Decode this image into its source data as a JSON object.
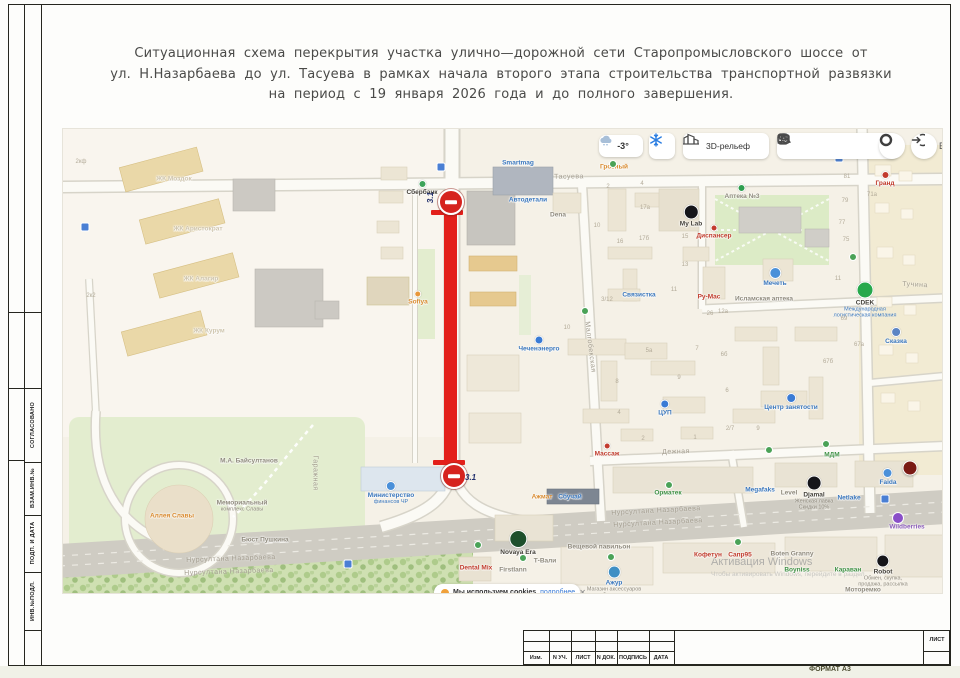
{
  "sheet": {
    "title_lines": [
      "Ситуационная схема перекрытия участка улично—дорожной сети Старопромысловского шоссе от",
      "ул. Н.Назарбаева до ул. Тасуева в рамках начала второго этапа строительства транспортной развязки",
      "на период с 19 января 2026 года и до полного завершения."
    ],
    "side_stamps": [
      "СОГЛАСОВАНО",
      "ВЗАМ.ИНВ.№",
      "ПОДП. И ДАТА",
      "ИНВ.№ПОДЛ."
    ],
    "title_block": {
      "columns": [
        "Изм.",
        "N УЧ.",
        "ЛИСТ",
        "N ДОК.",
        "ПОДПИСЬ",
        "ДАТА"
      ],
      "sheet_label": "ЛИСТ",
      "format_label": "ФОРМАТ А3"
    }
  },
  "map": {
    "controls": {
      "temperature": "-3°",
      "relief_label": "3D-рельеф",
      "login_hint": "В",
      "icon_names": [
        "weather-cloud-icon",
        "snowflake-icon",
        "3d-buildings-icon",
        "attractions-icon",
        "friends-icon",
        "briefcase-icon",
        "parking-icon",
        "layers-icon",
        "compass-icon",
        "login-arrow-icon"
      ]
    },
    "closure": {
      "sign_code": "3.1",
      "color": "#e3201b"
    },
    "cookie_banner": {
      "text": "Мы используем cookies",
      "link_label": "подробнее",
      "close_label": "✕"
    },
    "watermark": {
      "line1": "Активация Windows",
      "line2": "Чтобы активировать Windows, перейдите в раздел"
    },
    "streets": [
      {
        "label": "Тасуева",
        "x": 568,
        "y": 176,
        "r": -1
      },
      {
        "label": "Нурсултана Назарбаева",
        "x": 230,
        "y": 558,
        "r": -2
      },
      {
        "label": "Нурсултана Назарбаева",
        "x": 228,
        "y": 571,
        "r": -2
      },
      {
        "label": "Нурсултана Назарбаева",
        "x": 655,
        "y": 510,
        "r": -3
      },
      {
        "label": "Нурсултана Назарбаева",
        "x": 657,
        "y": 522,
        "r": -3
      },
      {
        "label": "Дежная",
        "x": 675,
        "y": 451,
        "r": -2
      },
      {
        "label": "Малгобекская",
        "x": 589,
        "y": 346,
        "r": 83
      },
      {
        "label": "Тучина",
        "x": 914,
        "y": 284,
        "r": 3
      },
      {
        "label": "Гаражная",
        "x": 314,
        "y": 472,
        "r": 90
      }
    ],
    "pois": [
      {
        "label": "Сбербанк",
        "x": 421,
        "y": 187,
        "c": "dark",
        "dot": "#3da35a",
        "ds": 6
      },
      {
        "label": "Smartmag",
        "x": 517,
        "y": 162,
        "c": "blue"
      },
      {
        "label": "Грозный",
        "x": 613,
        "y": 166,
        "c": "orange"
      },
      {
        "label": "Автодетали",
        "x": 527,
        "y": 199,
        "c": "blue"
      },
      {
        "label": "Dena",
        "x": 557,
        "y": 214,
        "c": "grey"
      },
      {
        "label": "My Lab",
        "x": 690,
        "y": 215,
        "c": "dark",
        "dot": "#15151a",
        "ds": 13
      },
      {
        "label": "Аптека №3",
        "x": 741,
        "y": 191,
        "c": "grey",
        "dot": "#2e9e4f",
        "ds": 6
      },
      {
        "label": "Гранд",
        "x": 884,
        "y": 178,
        "c": "red",
        "dot": "#c23b2e",
        "ds": 6
      },
      {
        "label": "Диспансер",
        "x": 713,
        "y": 231,
        "c": "red",
        "dot": "#c23b2e",
        "ds": 5
      },
      {
        "label": "Мечеть",
        "x": 774,
        "y": 276,
        "c": "blue",
        "dot": "#4a90d9",
        "ds": 10
      },
      {
        "label": "Ру-Мас",
        "x": 708,
        "y": 296,
        "c": "red"
      },
      {
        "label": "Исламская аптека",
        "x": 763,
        "y": 298,
        "c": "grey"
      },
      {
        "label": "CDEK",
        "x": 864,
        "y": 299,
        "c": "dark",
        "dot": "#27a84c",
        "ds": 15,
        "sub": [
          "Международная",
          "логистическая компания"
        ],
        "subc": "blue"
      },
      {
        "label": "Сказка",
        "x": 895,
        "y": 335,
        "c": "blue",
        "dot": "#5b84c4",
        "ds": 8
      },
      {
        "label": "Связистка",
        "x": 638,
        "y": 294,
        "c": "blue"
      },
      {
        "label": "Чеченэнерго",
        "x": 538,
        "y": 343,
        "c": "blue",
        "dot": "#3a7bd5",
        "ds": 7
      },
      {
        "label": "Sofiya",
        "x": 417,
        "y": 297,
        "c": "orange",
        "dot": "#e8973a",
        "ds": 5
      },
      {
        "label": "ЦУП",
        "x": 664,
        "y": 407,
        "c": "blue",
        "dot": "#3a7bd5",
        "ds": 7
      },
      {
        "label": "Центр занятости",
        "x": 790,
        "y": 401,
        "c": "blue",
        "dot": "#3a7bd5",
        "ds": 8
      },
      {
        "label": "Массаж",
        "x": 606,
        "y": 449,
        "c": "red",
        "dot": "#c23b2e",
        "ds": 5
      },
      {
        "label": "МДМ",
        "x": 831,
        "y": 454,
        "c": "green"
      },
      {
        "label": "Faida",
        "x": 887,
        "y": 476,
        "c": "blue",
        "dot": "#4a90d9",
        "ds": 8
      },
      {
        "label": "Орматек",
        "x": 667,
        "y": 492,
        "c": "green"
      },
      {
        "label": "Megafaks",
        "x": 759,
        "y": 489,
        "c": "blue"
      },
      {
        "label": "Level",
        "x": 788,
        "y": 492,
        "c": "grey"
      },
      {
        "label": "Djamal",
        "x": 813,
        "y": 492,
        "c": "dark",
        "dot": "#15151a",
        "ds": 13,
        "sub": [
          "Женская лавка",
          "Скидки 10%"
        ]
      },
      {
        "label": "Netlake",
        "x": 848,
        "y": 497,
        "c": "blue"
      },
      {
        "label": "Ажмат",
        "x": 541,
        "y": 496,
        "c": "orange"
      },
      {
        "label": "Сбучай",
        "x": 569,
        "y": 496,
        "c": "blue"
      },
      {
        "label": "Кофетун",
        "x": 707,
        "y": 554,
        "c": "red"
      },
      {
        "label": "Сапр95",
        "x": 739,
        "y": 554,
        "c": "red"
      },
      {
        "label": "Boten Granny",
        "x": 791,
        "y": 553,
        "c": "grey"
      },
      {
        "label": "Boyniss",
        "x": 796,
        "y": 569,
        "c": "green"
      },
      {
        "label": "Караван",
        "x": 847,
        "y": 569,
        "c": "green"
      },
      {
        "label": "Robot",
        "x": 882,
        "y": 570,
        "c": "dark",
        "dot": "#15151a",
        "ds": 11,
        "sub": [
          "Обмен, скупка,",
          "продажа, рассылка"
        ]
      },
      {
        "label": "Моторемко",
        "x": 862,
        "y": 589,
        "c": "grey"
      },
      {
        "label": "Wildberries",
        "x": 906,
        "y": 526,
        "c": "purple"
      },
      {
        "label": "Novaya Era",
        "x": 517,
        "y": 542,
        "c": "dark",
        "dot": "#1d4f2c",
        "ds": 16
      },
      {
        "label": "Вещевой павильон",
        "x": 598,
        "y": 546,
        "c": "grey"
      },
      {
        "label": "Dental Mix",
        "x": 475,
        "y": 567,
        "c": "red"
      },
      {
        "label": "Firstlann",
        "x": 512,
        "y": 569,
        "c": "grey"
      },
      {
        "label": "Т-Вали",
        "x": 544,
        "y": 560,
        "c": "grey"
      },
      {
        "label": "Ажур",
        "x": 613,
        "y": 581,
        "c": "blue",
        "dot": "#3f8fc4",
        "ds": 11,
        "sub": [
          "Магазин аксессуаров",
          "и бижутерии"
        ]
      },
      {
        "label": "Аллея Славы",
        "x": 171,
        "y": 515,
        "c": "orange"
      },
      {
        "label": "Мемориальный",
        "x": 241,
        "y": 505,
        "c": "grey",
        "sub": [
          "комплекс Славы"
        ]
      },
      {
        "label": "М.А. Байсултанов",
        "x": 248,
        "y": 460,
        "c": "grey"
      },
      {
        "label": "Бюст Пушкина",
        "x": 264,
        "y": 539,
        "c": "grey"
      },
      {
        "label": "Министерство",
        "x": 390,
        "y": 492,
        "c": "blue",
        "sub": [
          "финансов ЧР"
        ],
        "subc": "blue",
        "dot": "#4a90d9",
        "ds": 8
      },
      {
        "label": "ЖК Моздок",
        "x": 173,
        "y": 178,
        "c": "faint"
      },
      {
        "label": "ЖК Аристократ",
        "x": 197,
        "y": 228,
        "c": "faint"
      },
      {
        "label": "ЖК Алагир",
        "x": 200,
        "y": 278,
        "c": "faint"
      },
      {
        "label": "ЖК Курум",
        "x": 208,
        "y": 330,
        "c": "faint"
      }
    ],
    "house_numbers": [
      {
        "t": "2",
        "x": 607,
        "y": 186
      },
      {
        "t": "4",
        "x": 641,
        "y": 183
      },
      {
        "t": "17а",
        "x": 644,
        "y": 207
      },
      {
        "t": "17б",
        "x": 643,
        "y": 238
      },
      {
        "t": "16",
        "x": 619,
        "y": 241
      },
      {
        "t": "10",
        "x": 596,
        "y": 225
      },
      {
        "t": "15",
        "x": 684,
        "y": 236
      },
      {
        "t": "13",
        "x": 684,
        "y": 264
      },
      {
        "t": "11",
        "x": 673,
        "y": 289
      },
      {
        "t": "3/12",
        "x": 606,
        "y": 299
      },
      {
        "t": "81",
        "x": 846,
        "y": 176
      },
      {
        "t": "79",
        "x": 844,
        "y": 200
      },
      {
        "t": "77",
        "x": 841,
        "y": 222
      },
      {
        "t": "75",
        "x": 845,
        "y": 239
      },
      {
        "t": "71а",
        "x": 871,
        "y": 194
      },
      {
        "t": "11",
        "x": 837,
        "y": 278
      },
      {
        "t": "26",
        "x": 709,
        "y": 313
      },
      {
        "t": "12а",
        "x": 722,
        "y": 311
      },
      {
        "t": "10",
        "x": 566,
        "y": 327
      },
      {
        "t": "5а",
        "x": 648,
        "y": 350
      },
      {
        "t": "7",
        "x": 696,
        "y": 348
      },
      {
        "t": "9",
        "x": 678,
        "y": 377
      },
      {
        "t": "8",
        "x": 616,
        "y": 381
      },
      {
        "t": "4",
        "x": 618,
        "y": 412
      },
      {
        "t": "2",
        "x": 642,
        "y": 438
      },
      {
        "t": "1",
        "x": 694,
        "y": 437
      },
      {
        "t": "2/7",
        "x": 729,
        "y": 428
      },
      {
        "t": "9",
        "x": 757,
        "y": 428
      },
      {
        "t": "6",
        "x": 726,
        "y": 390
      },
      {
        "t": "6б",
        "x": 723,
        "y": 354
      },
      {
        "t": "69",
        "x": 843,
        "y": 318
      },
      {
        "t": "67а",
        "x": 858,
        "y": 344
      },
      {
        "t": "67б",
        "x": 827,
        "y": 361
      },
      {
        "t": "2кф",
        "x": 80,
        "y": 161
      },
      {
        "t": "2к2",
        "x": 90,
        "y": 295
      }
    ],
    "icons": [
      {
        "t": "transit",
        "x": 440,
        "y": 166
      },
      {
        "t": "transit",
        "x": 838,
        "y": 157
      },
      {
        "t": "transit",
        "x": 347,
        "y": 563
      },
      {
        "t": "transit",
        "x": 884,
        "y": 498
      },
      {
        "t": "transit",
        "x": 84,
        "y": 226
      },
      {
        "t": "green",
        "x": 584,
        "y": 310
      },
      {
        "t": "green",
        "x": 612,
        "y": 163
      },
      {
        "t": "green",
        "x": 668,
        "y": 484
      },
      {
        "t": "green",
        "x": 737,
        "y": 541
      },
      {
        "t": "green",
        "x": 825,
        "y": 443
      },
      {
        "t": "green",
        "x": 852,
        "y": 256
      },
      {
        "t": "green",
        "x": 768,
        "y": 449
      },
      {
        "t": "green",
        "x": 477,
        "y": 544
      },
      {
        "t": "green",
        "x": 522,
        "y": 557
      },
      {
        "t": "green",
        "x": 610,
        "y": 556
      },
      {
        "t": "darkred",
        "x": 909,
        "y": 467
      },
      {
        "t": "purple",
        "x": 897,
        "y": 517
      }
    ]
  }
}
